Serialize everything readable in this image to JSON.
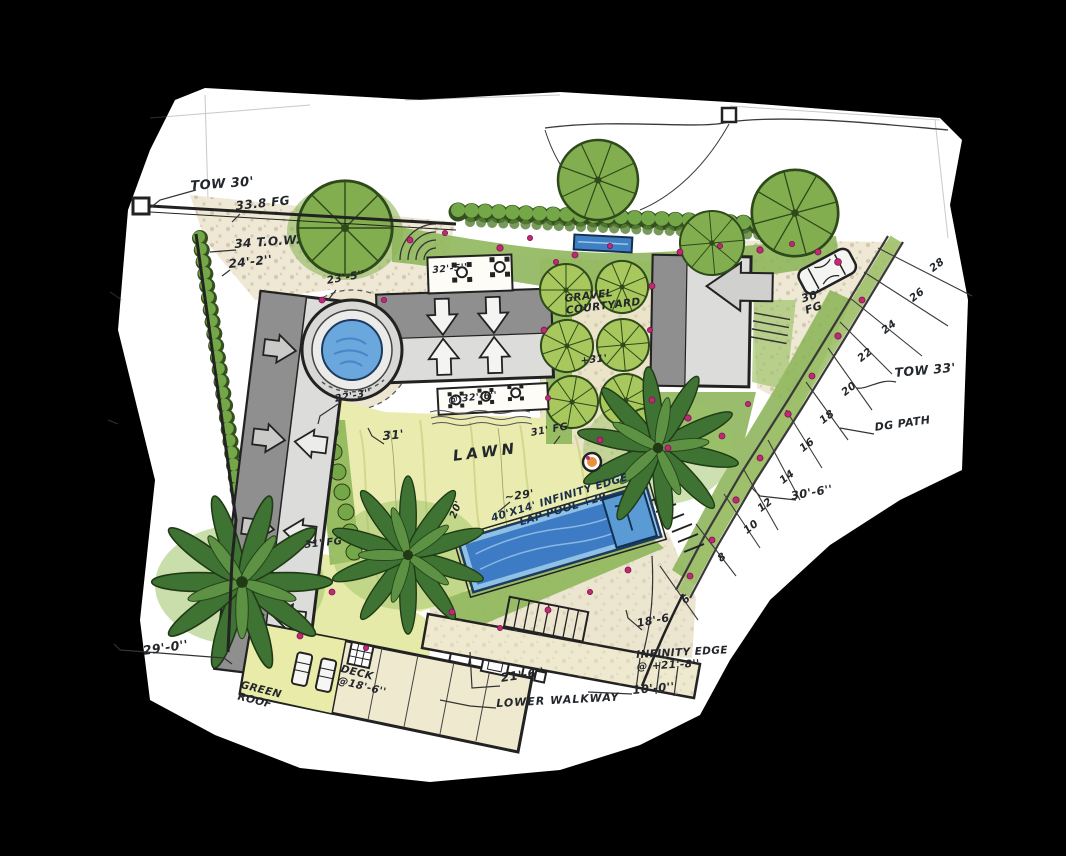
{
  "drawing": {
    "type": "hand-rendered landscape site plan",
    "palette": {
      "paper": "#ffffff",
      "ink": "#23272b",
      "lawn": "#e9ecae",
      "planting": "#8cb558",
      "hedge": "#74a747",
      "palm": "#3f7334",
      "water_light": "#8fc0e6",
      "water_deep": "#2f6fbe",
      "building_dark": "#8f8f8f",
      "building_light": "#dcdcda",
      "gravel": "#efe8d5",
      "flower": "#bf2a78"
    }
  },
  "annotations": {
    "tow_30": "TOW 30'",
    "fg_33_8": "33.8 FG",
    "tow_34": "34 T.O.W.",
    "dim_24_2": "24'-2''",
    "dim_23_5": "23'-5''",
    "dim_32_5": "32'-5''",
    "dim_22_3": "22'-3''",
    "dim_32_6": "@ 32'-6''",
    "dim_31": "31'",
    "lawn": "LAWN",
    "fg_31_right": "31' FG",
    "fg_31_left": "31' FG",
    "dim_29": "~29'",
    "dim_20": "20'",
    "pool": "40'X14' INFINITY EDGE\nLAP POOL +29",
    "gravel_courtyard": "GRAVEL\nCOURTYARD",
    "elev_31": "+31'",
    "fg_30": "30'\nFG",
    "tow_33": "TOW 33'",
    "dg_path": "DG PATH",
    "dim_30_6": "30'-6''",
    "dim_18_6": "18'-6",
    "infinity_edge": "INFINITY EDGE\n@ +21'-8''",
    "dim_10_0": "10'-0''",
    "dim_21_6": "21'-6''",
    "lower_walkway": "LOWER WALKWAY",
    "dim_29_0": "29'-0''",
    "green_roof": "GREEN\nROOF",
    "deck": "DECK\n@18'-6''"
  },
  "contours": [
    "28",
    "26",
    "24",
    "22",
    "20",
    "18",
    "16",
    "14",
    "12",
    "10",
    "8",
    "6"
  ]
}
